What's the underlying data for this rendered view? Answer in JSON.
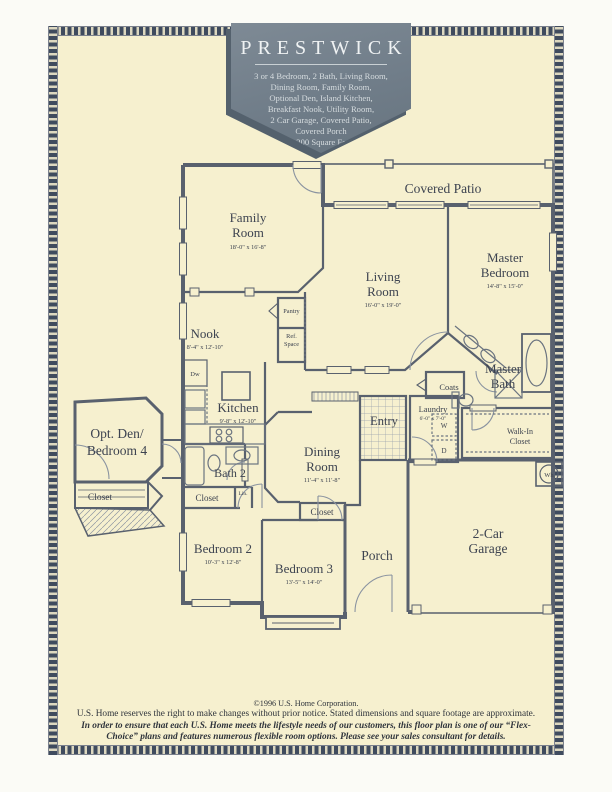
{
  "banner": {
    "title": "PRESTWICK",
    "lines": [
      "3 or 4 Bedroom, 2 Bath, Living Room,",
      "Dining Room, Family Room,",
      "Optional Den, Island Kitchen,",
      "Breakfast Nook, Utility Room,",
      "2 Car Garage, Covered Patio,",
      "Covered Porch",
      "2,200 Square Feet"
    ]
  },
  "rooms": {
    "covered_patio": {
      "name": "Covered Patio"
    },
    "family": {
      "l1": "Family",
      "l2": "Room",
      "dims": "18'-0\" x 16'-8\""
    },
    "living": {
      "l1": "Living",
      "l2": "Room",
      "dims": "16'-0\" x 19'-0\""
    },
    "master_bedroom": {
      "l1": "Master",
      "l2": "Bedroom",
      "dims": "14'-8\" x 15'-0\""
    },
    "nook": {
      "l1": "Nook",
      "dims": "8'-4\" x 12'-10\""
    },
    "kitchen": {
      "l1": "Kitchen",
      "dims": "9'-8\" x 12'-10\""
    },
    "master_bath": {
      "l1": "Master",
      "l2": "Bath"
    },
    "laundry": {
      "l1": "Laundry",
      "dims": "6'-0\" x 7'-0\""
    },
    "entry": {
      "l1": "Entry"
    },
    "walk_in_closet": {
      "l1": "Walk-In",
      "l2": "Closet"
    },
    "opt_den": {
      "l1": "Opt. Den/",
      "l2": "Bedroom 4"
    },
    "dining": {
      "l1": "Dining",
      "l2": "Room",
      "dims": "11'-4\" x 11'-8\""
    },
    "bath2": {
      "l1": "Bath 2"
    },
    "bedroom2": {
      "l1": "Bedroom 2",
      "dims": "10'-3\" x 12'-8\""
    },
    "bedroom3": {
      "l1": "Bedroom 3",
      "dims": "13'-5\" x 14'-0\""
    },
    "porch": {
      "l1": "Porch"
    },
    "garage": {
      "l1": "2-Car",
      "l2": "Garage"
    }
  },
  "labels": {
    "pantry": "Pantry",
    "ref1": "Ref.",
    "ref2": "Space",
    "coats": "Coats",
    "closet": "Closet",
    "lin": "Lin.",
    "dw": "Dw",
    "washer": "W",
    "dryer": "D",
    "water_heater": "Wh"
  },
  "footer": {
    "line1": "©1996 U.S. Home Corporation.",
    "line2": "U.S. Home reserves the right to make changes without prior notice. Stated dimensions and square footage are approximate.",
    "line3": "In order to ensure that each U.S. Home meets the lifestyle needs of our customers, this floor plan is one of our “Flex-Choice” plans and features numerous flexible room options. Please see your sales consultant for details."
  },
  "colors": {
    "sheet": "#f6f0cf",
    "banner": "#74818d",
    "walls": "#59616e",
    "border": "#3f4b5e"
  }
}
